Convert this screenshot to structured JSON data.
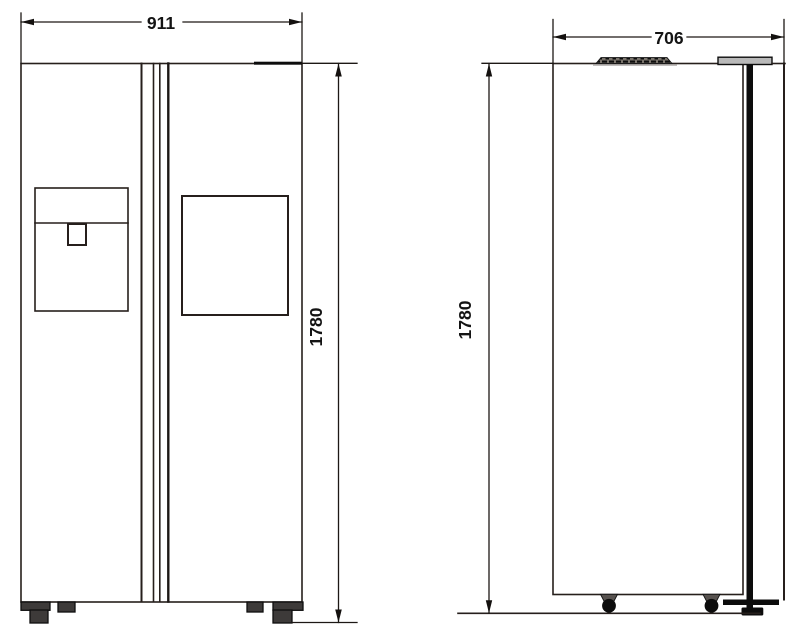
{
  "drawing": {
    "type": "technical-dimension-drawing",
    "subject": "side-by-side refrigerator, front and side elevation views",
    "views": {
      "front": {
        "width_dim": "911",
        "height_dim": "1780"
      },
      "side": {
        "depth_dim": "706",
        "height_dim": "1780"
      }
    },
    "colors": {
      "line": "#261f1c",
      "dark_fill": "#3d3a39",
      "cap_gray": "#b9b9b9",
      "text": "#141414",
      "background": "#ffffff"
    }
  }
}
